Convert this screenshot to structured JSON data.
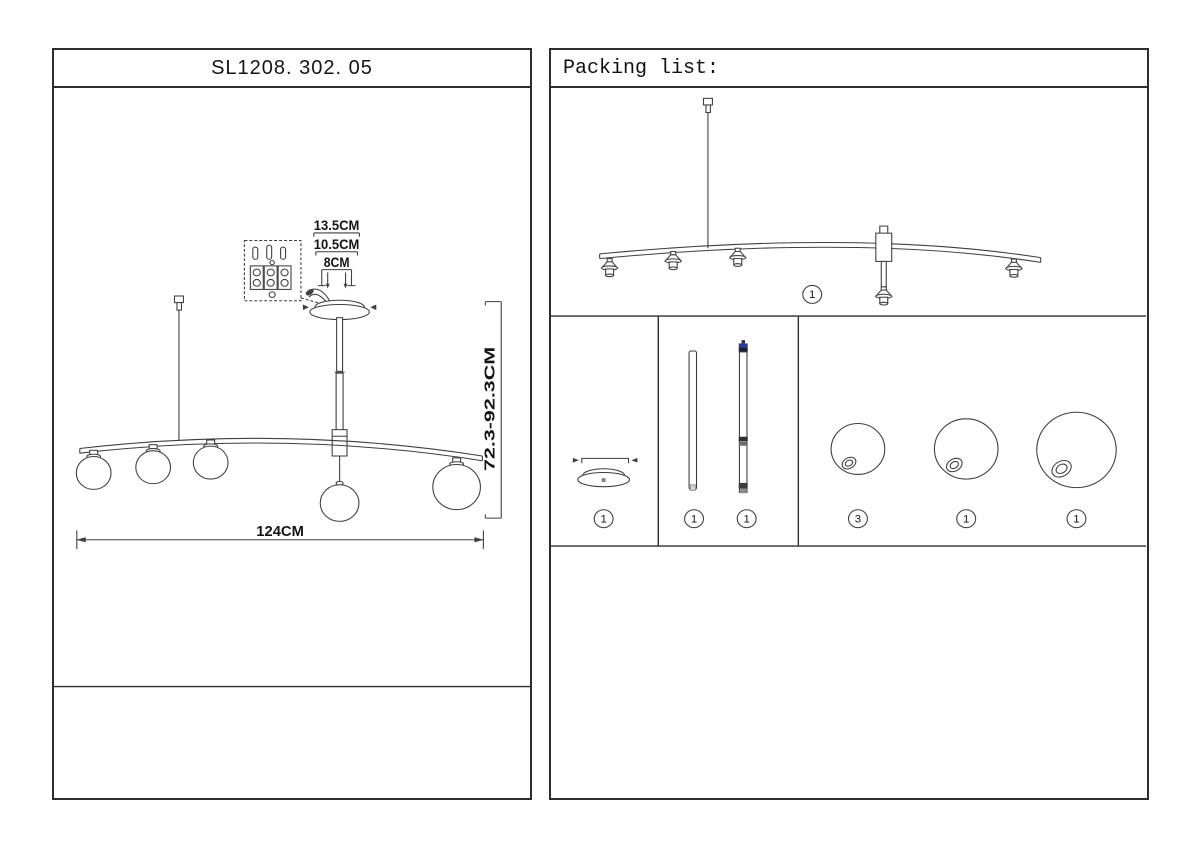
{
  "document": {
    "model_number": "SL1208. 302. 05",
    "packing_list_title": "Packing list:"
  },
  "dimensions": {
    "canopy_width_outer": "13.5CM",
    "canopy_width_mid": "10.5CM",
    "canopy_width_inner": "8CM",
    "drop_height_range": "72.3-92.3CM",
    "fixture_width": "124CM"
  },
  "packing_list": {
    "items": [
      {
        "part": "lamp-bar-assembly",
        "qty": "1"
      },
      {
        "part": "ceiling-canopy",
        "qty": "1"
      },
      {
        "part": "plain-rod",
        "qty": "1"
      },
      {
        "part": "connector-rod",
        "qty": "1"
      },
      {
        "part": "small-glass-globe",
        "qty": "3"
      },
      {
        "part": "medium-glass-globe",
        "qty": "1"
      },
      {
        "part": "large-glass-globe",
        "qty": "1"
      }
    ]
  },
  "colors": {
    "line": "#3f3f3f",
    "accent_blue": "#2b3a9a"
  }
}
